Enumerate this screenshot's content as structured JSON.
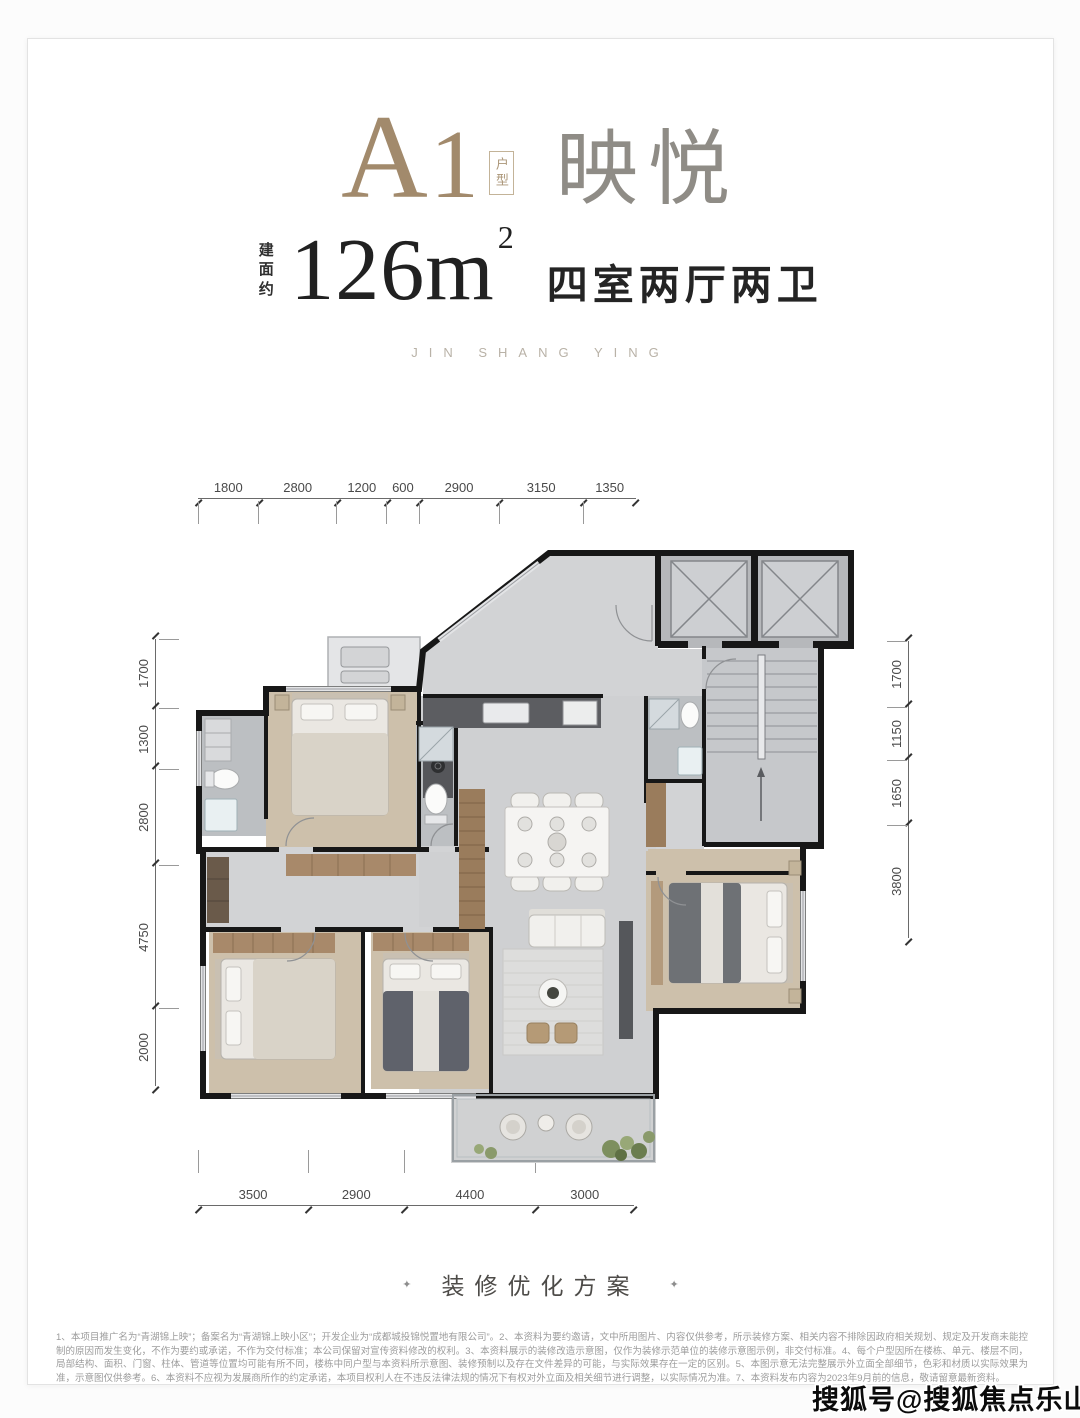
{
  "header": {
    "type_code_a": "A",
    "type_code_1": "1",
    "type_box": "户型",
    "name": "映悦",
    "area_prefix": "建面约",
    "area_value": "126m",
    "area_sup": "2",
    "rooms": "四室两厅两卫",
    "subtitle": "JIN SHANG YING"
  },
  "dimensions": {
    "top": [
      "1800",
      "2800",
      "1200",
      "600",
      "2900",
      "3150",
      "1350"
    ],
    "left": [
      "1700",
      "1300",
      "2800",
      "4750",
      "2000"
    ],
    "right": [
      "1700",
      "1150",
      "1650",
      "3800"
    ],
    "bottom": [
      "3500",
      "2900",
      "4400",
      "3000"
    ]
  },
  "footer": {
    "bullet": "✦",
    "program_label": "装修优化方案"
  },
  "disclaimer": "1、本项目推广名为“青湖锦上映”；备案名为“青湖锦上映小区”；开发企业为“成都城投锦悦置地有限公司”。2、本资料为要约邀请，文中所用图片、内容仅供参考，所示装修方案、相关内容不排除因政府相关规划、规定及开发商未能控制的原因而发生变化，不作为要约或承诺，不作为交付标准；本公司保留对宣传资料修改的权利。3、本资料展示的装修改造示意图，仅作为装修示范单位的装修示意图示例，非交付标准。4、每个户型因所在楼栋、单元、楼层不同，局部结构、面积、门窗、柱体、管道等位置均可能有所不同，楼栋中同户型与本资料所示意图、装修预制以及存在文件差异的可能，与实际效果存在一定的区别。5、本图示意无法完整展示外立面全部细节，色彩和材质以实际效果为准，示意图仅供参考。6、本资料不应视为发展商所作的约定承诺，本项目权利人在不违反法律法规的情况下有权对外立面及相关细节进行调整，以实际情况为准。7、本资料发布内容为2023年9月前的信息，敬请留意最新资料。",
  "watermark": "搜狐号@搜狐焦点乐山站"
}
